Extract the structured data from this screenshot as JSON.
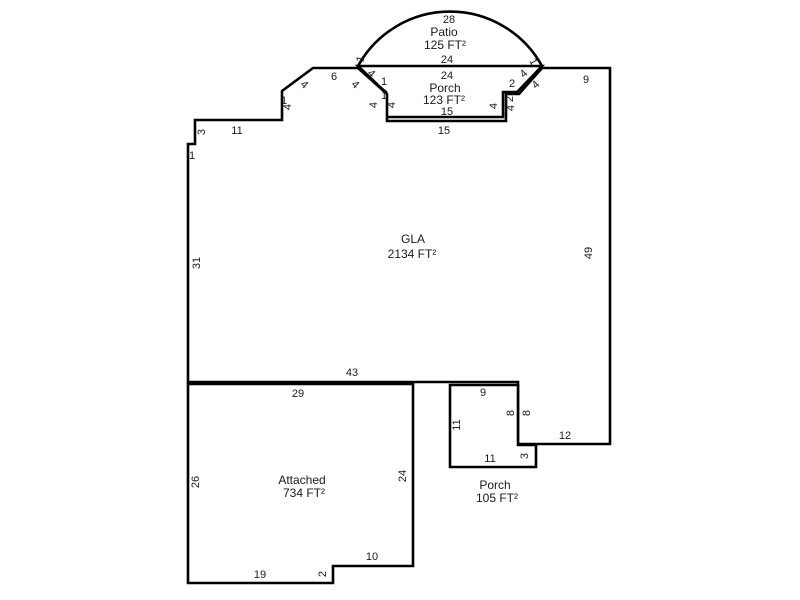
{
  "title": "Property floor plan sketch",
  "colors": {
    "background": "#ffffff",
    "line": "#000000",
    "text": "#1a1a1a"
  },
  "areas": [
    {
      "name": "GLA",
      "size": "2134 FT²"
    },
    {
      "name": "Attached",
      "size": "734 FT²"
    },
    {
      "name": "Porch",
      "size": "123 FT²"
    },
    {
      "name": "Porch",
      "size": "105 FT²"
    },
    {
      "name": "Patio",
      "size": "125 FT²"
    }
  ],
  "sketch": {
    "width": 800,
    "height": 600,
    "line_color": "#000000",
    "stroke_width": 2.6,
    "shapes": [
      {
        "name": "patio-outline",
        "type": "path",
        "fill": "none",
        "d": "M 358 66 A 105 105 0 0 1 542 66"
      },
      {
        "name": "porch-123-outline",
        "type": "polygon",
        "fill": "#ffffff",
        "points": "358,66 542,66 520,89 517,92 503,92 503,117 386,117 386,92 381,88"
      },
      {
        "name": "gla-outline",
        "type": "polygon",
        "fill": "#ffffff",
        "points": "195,120 282,120 282,91 313,68 358,68 387,94 387,121 506,121 506,94 519,94 542,68 610,68 610,444 518,444 518,382 188,382 188,144 195,144"
      },
      {
        "name": "attached-outline",
        "type": "polygon",
        "fill": "#ffffff",
        "points": "188,384 413,384 413,566 333,566 333,583 188,583"
      },
      {
        "name": "porch-105-outline",
        "type": "polygon",
        "fill": "#ffffff",
        "points": "450,385 518,385 518,445 536,445 536,467 450,467"
      }
    ],
    "labels": [
      {
        "t": "28",
        "x": 449,
        "y": 20,
        "r": 0,
        "k": "dim"
      },
      {
        "t": "Patio",
        "x": 444,
        "y": 33,
        "r": 0,
        "k": "name"
      },
      {
        "t": "125 FT²",
        "x": 445,
        "y": 46,
        "r": 0,
        "k": "area"
      },
      {
        "t": "24",
        "x": 447,
        "y": 60,
        "r": 0,
        "k": "dim"
      },
      {
        "t": "1",
        "x": 361,
        "y": 59,
        "r": -80,
        "k": "dim"
      },
      {
        "t": "1",
        "x": 533,
        "y": 62,
        "r": 60,
        "k": "dim"
      },
      {
        "t": "24",
        "x": 447,
        "y": 76,
        "r": 0,
        "k": "dim"
      },
      {
        "t": "Porch",
        "x": 445,
        "y": 89,
        "r": 0,
        "k": "name"
      },
      {
        "t": "123 FT²",
        "x": 444,
        "y": 101,
        "r": 0,
        "k": "area"
      },
      {
        "t": "15",
        "x": 447,
        "y": 112,
        "r": 0,
        "k": "dim"
      },
      {
        "t": "15",
        "x": 444,
        "y": 131,
        "r": 0,
        "k": "dim"
      },
      {
        "t": "4",
        "x": 371,
        "y": 74,
        "r": 43,
        "k": "dim"
      },
      {
        "t": "4",
        "x": 355,
        "y": 85,
        "r": 43,
        "k": "dim"
      },
      {
        "t": "1",
        "x": 384,
        "y": 82,
        "r": 0,
        "k": "dim"
      },
      {
        "t": "1",
        "x": 384,
        "y": 96,
        "r": 0,
        "k": "dim"
      },
      {
        "t": "4",
        "x": 374,
        "y": 105,
        "r": -90,
        "k": "dim"
      },
      {
        "t": "4",
        "x": 392,
        "y": 105,
        "r": -90,
        "k": "dim"
      },
      {
        "t": "4",
        "x": 524,
        "y": 74,
        "r": -43,
        "k": "dim"
      },
      {
        "t": "4",
        "x": 536,
        "y": 85,
        "r": -43,
        "k": "dim"
      },
      {
        "t": "2",
        "x": 512,
        "y": 84,
        "r": 0,
        "k": "dim"
      },
      {
        "t": "2",
        "x": 510,
        "y": 99,
        "r": -90,
        "k": "dim"
      },
      {
        "t": "4",
        "x": 494,
        "y": 106,
        "r": -90,
        "k": "dim"
      },
      {
        "t": "4",
        "x": 511,
        "y": 108,
        "r": -90,
        "k": "dim"
      },
      {
        "t": "1",
        "x": 192,
        "y": 156,
        "r": 0,
        "k": "dim"
      },
      {
        "t": "3",
        "x": 202,
        "y": 132,
        "r": -90,
        "k": "dim"
      },
      {
        "t": "11",
        "x": 237,
        "y": 131,
        "r": 0,
        "k": "dim"
      },
      {
        "t": "1",
        "x": 284,
        "y": 101,
        "r": 0,
        "k": "dim"
      },
      {
        "t": "4",
        "x": 288,
        "y": 107,
        "r": -90,
        "k": "dim"
      },
      {
        "t": "4",
        "x": 304,
        "y": 85,
        "r": 43,
        "k": "dim"
      },
      {
        "t": "6",
        "x": 334,
        "y": 77,
        "r": 0,
        "k": "dim"
      },
      {
        "t": "31",
        "x": 197,
        "y": 263,
        "r": -90,
        "k": "dim"
      },
      {
        "t": "9",
        "x": 586,
        "y": 80,
        "r": 0,
        "k": "dim"
      },
      {
        "t": "49",
        "x": 589,
        "y": 253,
        "r": -90,
        "k": "dim"
      },
      {
        "t": "12",
        "x": 565,
        "y": 436,
        "r": 0,
        "k": "dim"
      },
      {
        "t": "43",
        "x": 352,
        "y": 373,
        "r": 0,
        "k": "dim"
      },
      {
        "t": "GLA",
        "x": 413,
        "y": 240,
        "r": 0,
        "k": "name"
      },
      {
        "t": "2134 FT²",
        "x": 412,
        "y": 255,
        "r": 0,
        "k": "area"
      },
      {
        "t": "9",
        "x": 483,
        "y": 393,
        "r": 0,
        "k": "dim"
      },
      {
        "t": "11",
        "x": 457,
        "y": 425,
        "r": -90,
        "k": "dim"
      },
      {
        "t": "8",
        "x": 511,
        "y": 413,
        "r": -90,
        "k": "dim"
      },
      {
        "t": "8",
        "x": 527,
        "y": 413,
        "r": -90,
        "k": "dim"
      },
      {
        "t": "11",
        "x": 490,
        "y": 459,
        "r": 0,
        "k": "dim"
      },
      {
        "t": "3",
        "x": 525,
        "y": 456,
        "r": -90,
        "k": "dim"
      },
      {
        "t": "Porch",
        "x": 495,
        "y": 486,
        "r": 0,
        "k": "name"
      },
      {
        "t": "105 FT²",
        "x": 497,
        "y": 499,
        "r": 0,
        "k": "area"
      },
      {
        "t": "29",
        "x": 298,
        "y": 394,
        "r": 0,
        "k": "dim"
      },
      {
        "t": "26",
        "x": 196,
        "y": 482,
        "r": -90,
        "k": "dim"
      },
      {
        "t": "24",
        "x": 403,
        "y": 476,
        "r": -90,
        "k": "dim"
      },
      {
        "t": "Attached",
        "x": 302,
        "y": 481,
        "r": 0,
        "k": "name"
      },
      {
        "t": "734 FT²",
        "x": 304,
        "y": 494,
        "r": 0,
        "k": "area"
      },
      {
        "t": "19",
        "x": 260,
        "y": 575,
        "r": 0,
        "k": "dim"
      },
      {
        "t": "2",
        "x": 323,
        "y": 574,
        "r": -90,
        "k": "dim"
      },
      {
        "t": "10",
        "x": 372,
        "y": 557,
        "r": 0,
        "k": "dim"
      }
    ]
  }
}
